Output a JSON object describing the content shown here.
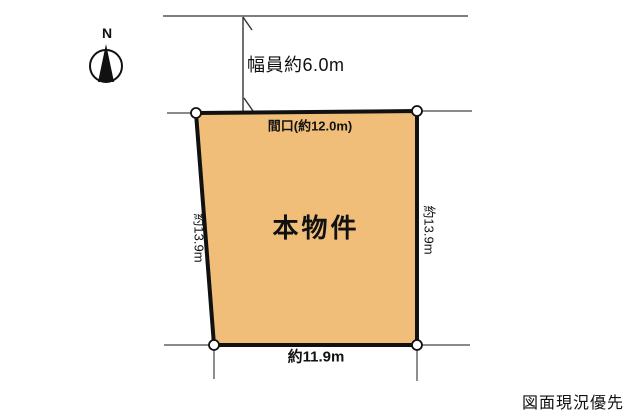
{
  "diagram": {
    "compass": {
      "label": "N"
    },
    "road": {
      "width_label": "幅員約6.0m"
    },
    "parcel": {
      "name": "本物件",
      "fill_color": "#F0BE78",
      "border_color": "#111111",
      "dimensions": {
        "frontage": "間口(約12.0m)",
        "left_depth": "約13.9m",
        "right_depth": "約13.9m",
        "bottom_width": "約11.9m"
      }
    },
    "note": "図面現況優先"
  }
}
